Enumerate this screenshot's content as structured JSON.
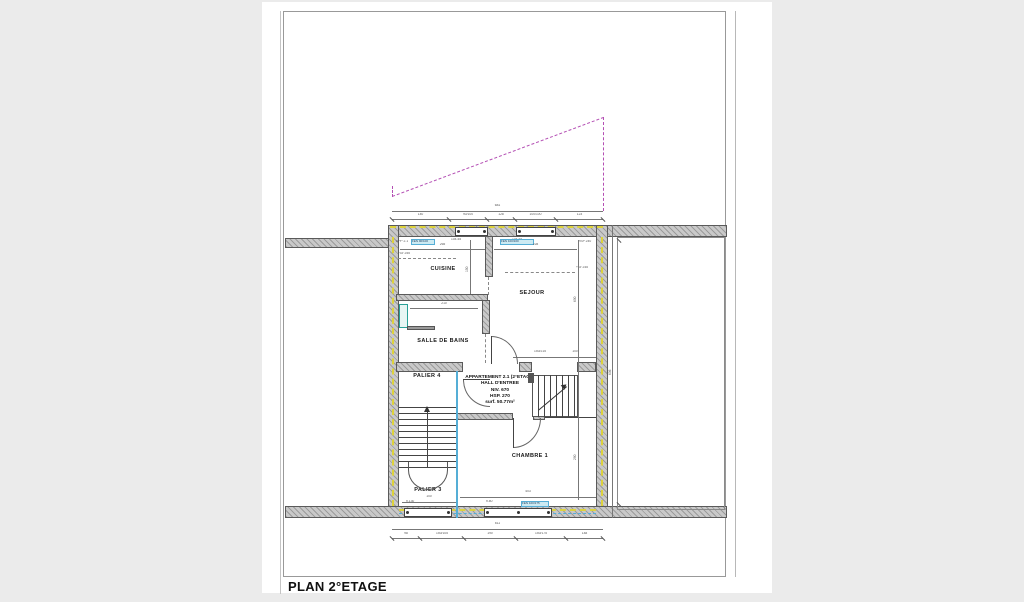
{
  "sheet": {
    "title": "PLAN 2°ETAGE"
  },
  "rooms": {
    "cuisine": "CUISINE",
    "sejour": "SEJOUR",
    "salle_de_bains": "SALLE DE BAINS",
    "palier4": "PALIER 4",
    "palier3": "PALIER 3",
    "chambre1": "CHAMBRE 1"
  },
  "apartment": {
    "line1": "APPARTEMENT 2.1 (2°ETAGE)",
    "line2": "HALL D'ENTREE",
    "line3": "NIV. 670",
    "line4": "HSP. 270",
    "line5": "surf. 50.77m²"
  },
  "dims": {
    "top_total": "681",
    "top_segments": [
      "140",
      "90/100",
      "128",
      "100/100",
      "123"
    ],
    "bottom_total": "611",
    "bottom_segments": [
      "98",
      "150/105",
      "190",
      "150/175",
      "148"
    ],
    "cuisine_width": "265",
    "cuisine_height": "150",
    "partition": "76",
    "sejour_width": "228",
    "sejour_height": "600",
    "bath_width": "210",
    "chambre_width": "403",
    "chambre_height": "290",
    "palier3_width": "100",
    "door_note": "150/215",
    "door_note2": "100",
    "right_side": "606"
  },
  "notes": {
    "level_left": "+Gr 255",
    "level_right": "+Gr 245",
    "app_ref": "APP 2.1",
    "hsp_right": "HSP 240",
    "sill_top_1": "104.45",
    "sill_top_2": "104.45",
    "sill_bottom_1": "h.130",
    "sill_bottom_2": "h.80",
    "chip_top_left": "FEN 90/100",
    "chip_top_center": "FEN 100/100",
    "chip_bottom": "FEN 100/175"
  },
  "colors": {
    "backdrop": "#ebebeb",
    "sheet_bg": "#ffffff",
    "wall_fill": "#c9c9c9",
    "insulation_yellow": "#ddd23c",
    "boundary_blue": "#55aed6",
    "roof_magenta": "#b44fb4",
    "chip_bg": "#cdeaf2"
  }
}
